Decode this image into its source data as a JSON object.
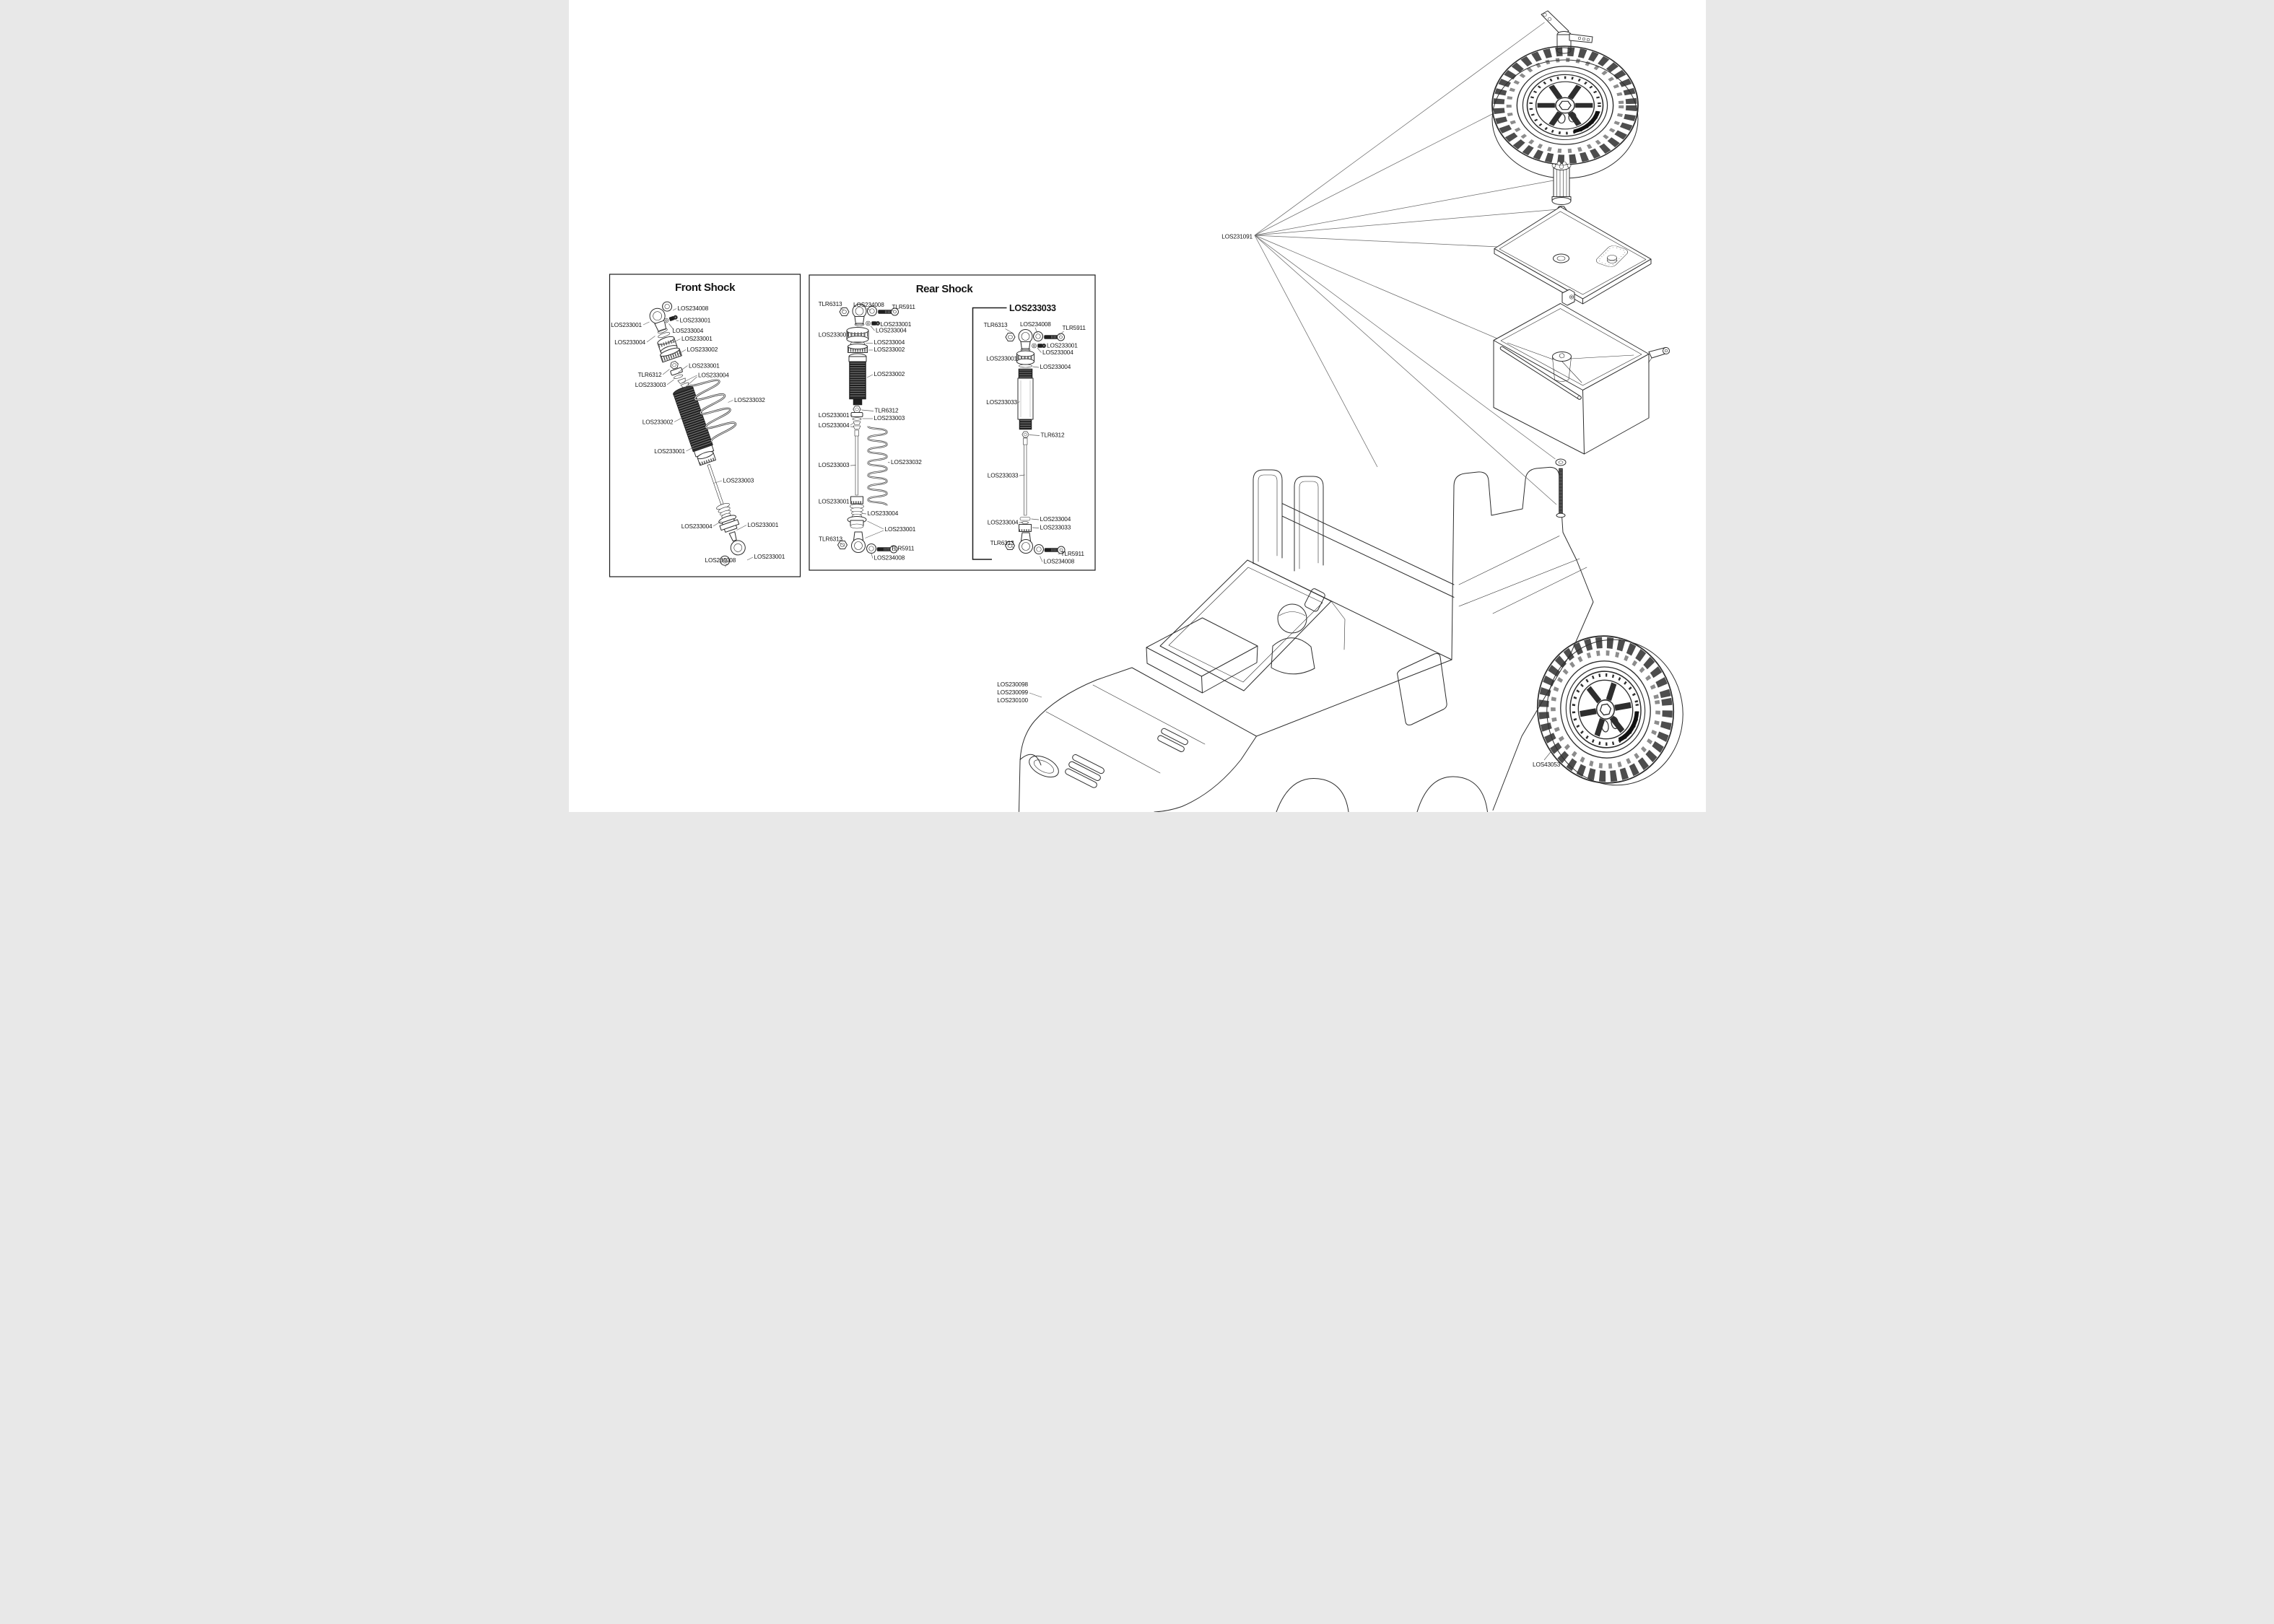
{
  "page": {
    "background": "#ffffff",
    "line_color": "#2e2e2e"
  },
  "panels": {
    "front_shock": {
      "title": "Front Shock",
      "labels": [
        "LOS234008",
        "LOS233001",
        "LOS233001",
        "LOS233004",
        "LOS233004",
        "LOS233001",
        "LOS233002",
        "LOS233001",
        "TLR6312",
        "LOS233004",
        "LOS233003",
        "LOS233032",
        "LOS233002",
        "LOS233001",
        "LOS233003",
        "LOS233004",
        "LOS233001",
        "LOS234008",
        "LOS233001"
      ]
    },
    "rear_shock": {
      "title": "Rear Shock",
      "labels": [
        "TLR6313",
        "LOS234008",
        "TLR5911",
        "LOS233001",
        "LOS233004",
        "LOS233001",
        "LOS233004",
        "LOS233002",
        "LOS233002",
        "TLR6312",
        "LOS233001",
        "LOS233003",
        "LOS233004",
        "LOS233003",
        "LOS233032",
        "LOS233001",
        "LOS233004",
        "LOS233001",
        "TLR6313",
        "TLR5911",
        "LOS234008"
      ]
    },
    "los233033": {
      "title": "LOS233033",
      "labels": [
        "TLR6313",
        "LOS234008",
        "TLR5911",
        "LOS233001",
        "LOS233004",
        "LOS233001",
        "LOS233004",
        "LOS233033",
        "TLR6312",
        "LOS233033",
        "LOS233004",
        "LOS233004",
        "LOS233033",
        "TLR6313",
        "TLR5911",
        "LOS234008"
      ]
    }
  },
  "right_assembly": {
    "group_label": "LOS231091",
    "body_shell_labels": [
      "LOS230098",
      "LOS230099",
      "LOS230100"
    ],
    "rear_tire_label": "LOS43053",
    "tire_sidewall_text": "TRAIL GRAPPLER M/T"
  }
}
